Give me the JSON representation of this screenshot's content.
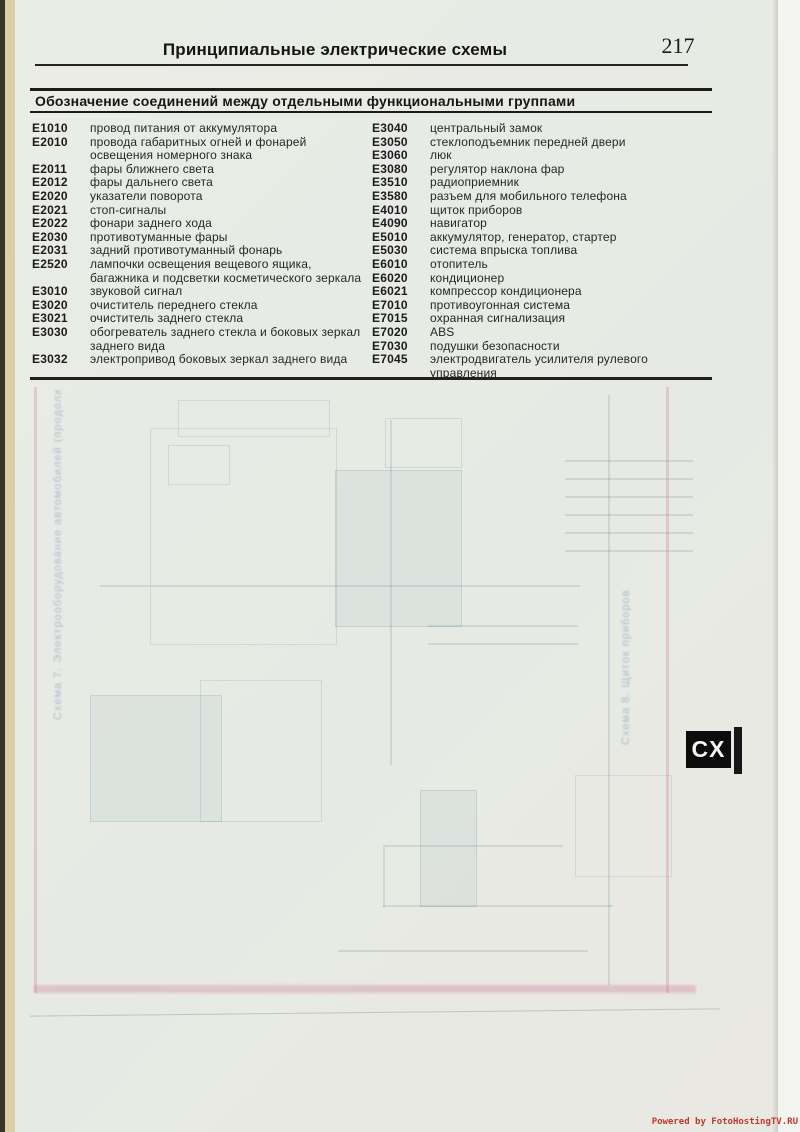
{
  "page": {
    "header_title": "Принципиальные электрические схемы",
    "page_number": "217",
    "section_title": "Обозначение соединений между отдельными функциональными группами"
  },
  "legend": {
    "left": [
      {
        "code": "E1010",
        "desc": "провод питания от аккумулятора"
      },
      {
        "code": "E2010",
        "desc": "провода габаритных огней и фонарей освещения номерного знака"
      },
      {
        "code": "E2011",
        "desc": "фары ближнего света"
      },
      {
        "code": "E2012",
        "desc": "фары дальнего света"
      },
      {
        "code": "E2020",
        "desc": "указатели поворота"
      },
      {
        "code": "E2021",
        "desc": "стоп-сигналы"
      },
      {
        "code": "E2022",
        "desc": "фонари заднего хода"
      },
      {
        "code": "E2030",
        "desc": "противотуманные фары"
      },
      {
        "code": "E2031",
        "desc": "задний противотуманный фонарь"
      },
      {
        "code": "E2520",
        "desc": "лампочки освещения вещевого ящика, багажника и подсветки косметического зеркала"
      },
      {
        "code": "E3010",
        "desc": "звуковой сигнал"
      },
      {
        "code": "E3020",
        "desc": "очиститель переднего стекла"
      },
      {
        "code": "E3021",
        "desc": "очиститель заднего стекла"
      },
      {
        "code": "E3030",
        "desc": "обогреватель заднего стекла и боковых зеркал заднего вида"
      },
      {
        "code": "E3032",
        "desc": "электропривод боковых зеркал заднего вида"
      }
    ],
    "right": [
      {
        "code": "E3040",
        "desc": "центральный замок"
      },
      {
        "code": "E3050",
        "desc": "стеклоподъемник передней двери"
      },
      {
        "code": "E3060",
        "desc": "люк"
      },
      {
        "code": "E3080",
        "desc": "регулятор наклона фар"
      },
      {
        "code": "E3510",
        "desc": "радиоприемник"
      },
      {
        "code": "E3580",
        "desc": "разъем для мобильного телефона"
      },
      {
        "code": "E4010",
        "desc": "щиток приборов"
      },
      {
        "code": "E4090",
        "desc": "навигатор"
      },
      {
        "code": "E5010",
        "desc": "аккумулятор, генератор, стартер"
      },
      {
        "code": "E5030",
        "desc": "система впрыска топлива"
      },
      {
        "code": "E6010",
        "desc": "отопитель"
      },
      {
        "code": "E6020",
        "desc": "кондиционер"
      },
      {
        "code": "E6021",
        "desc": "компрессор кондиционера"
      },
      {
        "code": "E7010",
        "desc": "противоугонная система"
      },
      {
        "code": "E7015",
        "desc": "охранная сигнализация"
      },
      {
        "code": "E7020",
        "desc": "ABS"
      },
      {
        "code": "E7030",
        "desc": "подушки безопасности"
      },
      {
        "code": "E7045",
        "desc": "электродвигатель усилителя рулевого управления"
      }
    ]
  },
  "ghost": {
    "left_text": "Схема 7. Электрооборудование автомобилей (продолжение)",
    "right_text": "Схема 8. Щиток приборов"
  },
  "tab": {
    "label": "CX"
  },
  "watermark": {
    "text": "Powered by FotoHostingTV.RU"
  },
  "colors": {
    "paper": "#e8eae5",
    "spine_cream": "#d9cfa2",
    "rule_black": "#1d1c18",
    "tab_bg": "#0c0c0c",
    "watermark_red": "#c2372b",
    "ghost_blue": "rgba(110,140,165,0.20)",
    "ghost_pink": "rgba(205,120,155,0.30)"
  }
}
